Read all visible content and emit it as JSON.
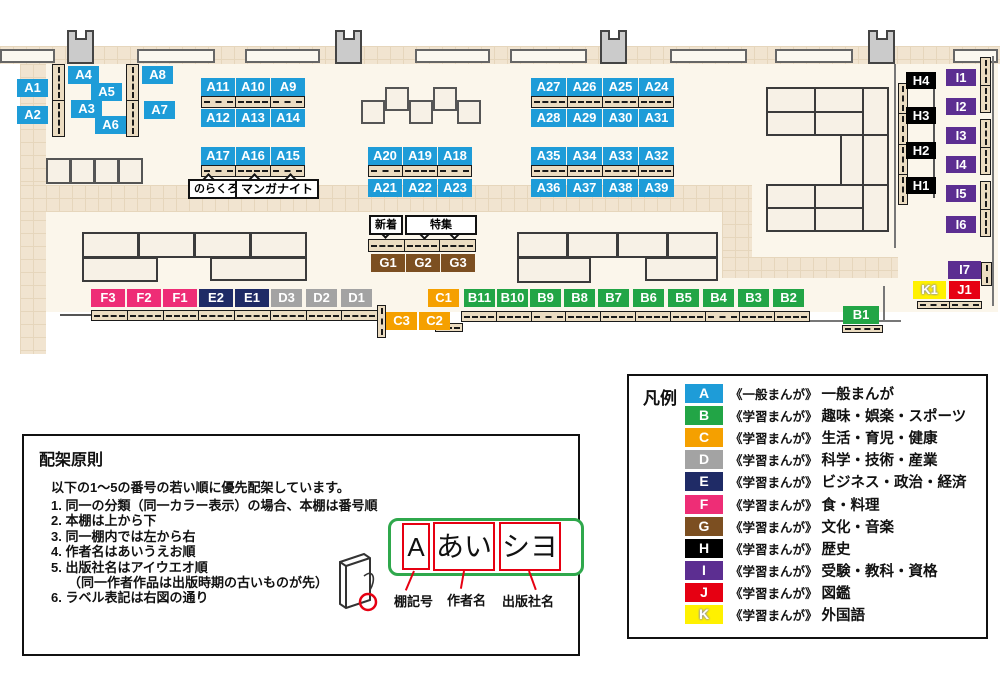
{
  "tags": {
    "A1": "A1",
    "A2": "A2",
    "A3": "A3",
    "A4": "A4",
    "A5": "A5",
    "A6": "A6",
    "A7": "A7",
    "A8": "A8",
    "A9": "A9",
    "A10": "A10",
    "A11": "A11",
    "A12": "A12",
    "A13": "A13",
    "A14": "A14",
    "A15": "A15",
    "A16": "A16",
    "A17": "A17",
    "A18": "A18",
    "A19": "A19",
    "A20": "A20",
    "A21": "A21",
    "A22": "A22",
    "A23": "A23",
    "A24": "A24",
    "A25": "A25",
    "A26": "A26",
    "A27": "A27",
    "A28": "A28",
    "A29": "A29",
    "A30": "A30",
    "A31": "A31",
    "A32": "A32",
    "A33": "A33",
    "A34": "A34",
    "A35": "A35",
    "A36": "A36",
    "A37": "A37",
    "A38": "A38",
    "A39": "A39",
    "B1": "B1",
    "B2": "B2",
    "B3": "B3",
    "B4": "B4",
    "B5": "B5",
    "B6": "B6",
    "B7": "B7",
    "B8": "B8",
    "B9": "B9",
    "B10": "B10",
    "B11": "B11",
    "C1": "C1",
    "C2": "C2",
    "C3": "C3",
    "D1": "D1",
    "D2": "D2",
    "D3": "D3",
    "E1": "E1",
    "E2": "E2",
    "F1": "F1",
    "F2": "F2",
    "F3": "F3",
    "G1": "G1",
    "G2": "G2",
    "G3": "G3",
    "H1": "H1",
    "H2": "H2",
    "H3": "H3",
    "H4": "H4",
    "I1": "I1",
    "I2": "I2",
    "I3": "I3",
    "I4": "I4",
    "I5": "I5",
    "I6": "I6",
    "I7": "I7",
    "J1": "J1",
    "K1": "K1"
  },
  "callouts": {
    "norakuro": "のらくろ",
    "manga_night": "マンガナイト",
    "new_arrivals": "新着",
    "feature": "特集"
  },
  "legend": {
    "title": "凡例",
    "rows": [
      {
        "letter": "A",
        "color": "#1E9CD8",
        "series": "《一般まんが》",
        "category": "一般まんが"
      },
      {
        "letter": "B",
        "color": "#22A546",
        "series": "《学習まんが》",
        "category": "趣味・娯楽・スポーツ"
      },
      {
        "letter": "C",
        "color": "#F5A000",
        "series": "《学習まんが》",
        "category": "生活・育児・健康"
      },
      {
        "letter": "D",
        "color": "#A3A3A3",
        "series": "《学習まんが》",
        "category": "科学・技術・産業"
      },
      {
        "letter": "E",
        "color": "#1F2B66",
        "series": "《学習まんが》",
        "category": "ビジネス・政治・経済"
      },
      {
        "letter": "F",
        "color": "#EE2D76",
        "series": "《学習まんが》",
        "category": "食・料理"
      },
      {
        "letter": "G",
        "color": "#7C4F21",
        "series": "《学習まんが》",
        "category": "文化・音楽"
      },
      {
        "letter": "H",
        "color": "#000000",
        "series": "《学習まんが》",
        "category": "歴史"
      },
      {
        "letter": "I",
        "color": "#5C2E91",
        "series": "《学習まんが》",
        "category": "受験・教科・資格"
      },
      {
        "letter": "J",
        "color": "#E60012",
        "series": "《学習まんが》",
        "category": "図鑑"
      },
      {
        "letter": "K",
        "color": "#FFF100",
        "series": "《学習まんが》",
        "category": "外国語"
      }
    ]
  },
  "principles": {
    "title": "配架原則",
    "intro": "以下の1～5の番号の若い順に優先配架しています。",
    "items": [
      "1. 同一の分類（同一カラー表示）の場合、本棚は番号順",
      "2. 本棚は上から下",
      "3. 同一棚内では左から右",
      "4. 作者名はあいうえお順",
      "5. 出版社名はアイウエオ順",
      "（同一作者作品は出版時期の古いものが先）",
      "6. ラベル表記は右図の通り"
    ]
  },
  "label_diagram": {
    "shelf_code": "A",
    "author": "あい",
    "publisher": "シヨ",
    "captions": {
      "shelf_code": "棚記号",
      "author": "作者名",
      "publisher": "出版社名"
    }
  }
}
